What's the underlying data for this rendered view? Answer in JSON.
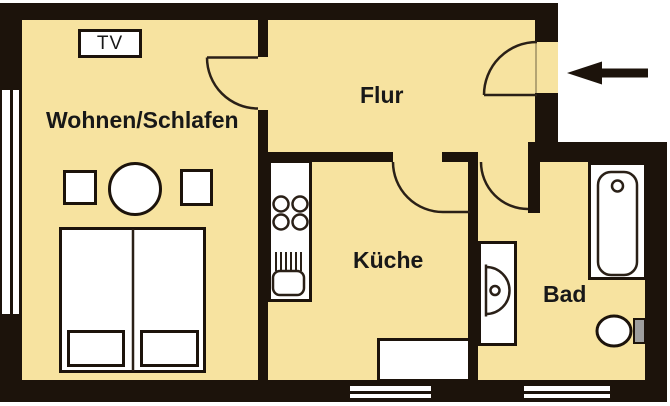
{
  "title": "Apartment floor plan",
  "rooms": {
    "living": {
      "label": "Wohnen/Schlafen"
    },
    "hall": {
      "label": "Flur"
    },
    "kitchen": {
      "label": "Küche"
    },
    "bath": {
      "label": "Bad"
    }
  },
  "tv": {
    "label": "TV"
  },
  "symbols": {
    "entrance_arrow": "arrow-left-icon",
    "bed": "double-bed",
    "table": "round-dining-table",
    "stove": "four-burner-hob",
    "sink": "kitchen-sink",
    "bathtub": "bathtub",
    "washbasin": "washbasin",
    "toilet": "toilet-with-cistern",
    "windows": "double-line-window"
  },
  "colors": {
    "floor": "#f7e3a0",
    "wall": "#1c130b",
    "background": "#ffffff",
    "cistern_gray": "#9e9e9e",
    "text": "#181818"
  }
}
